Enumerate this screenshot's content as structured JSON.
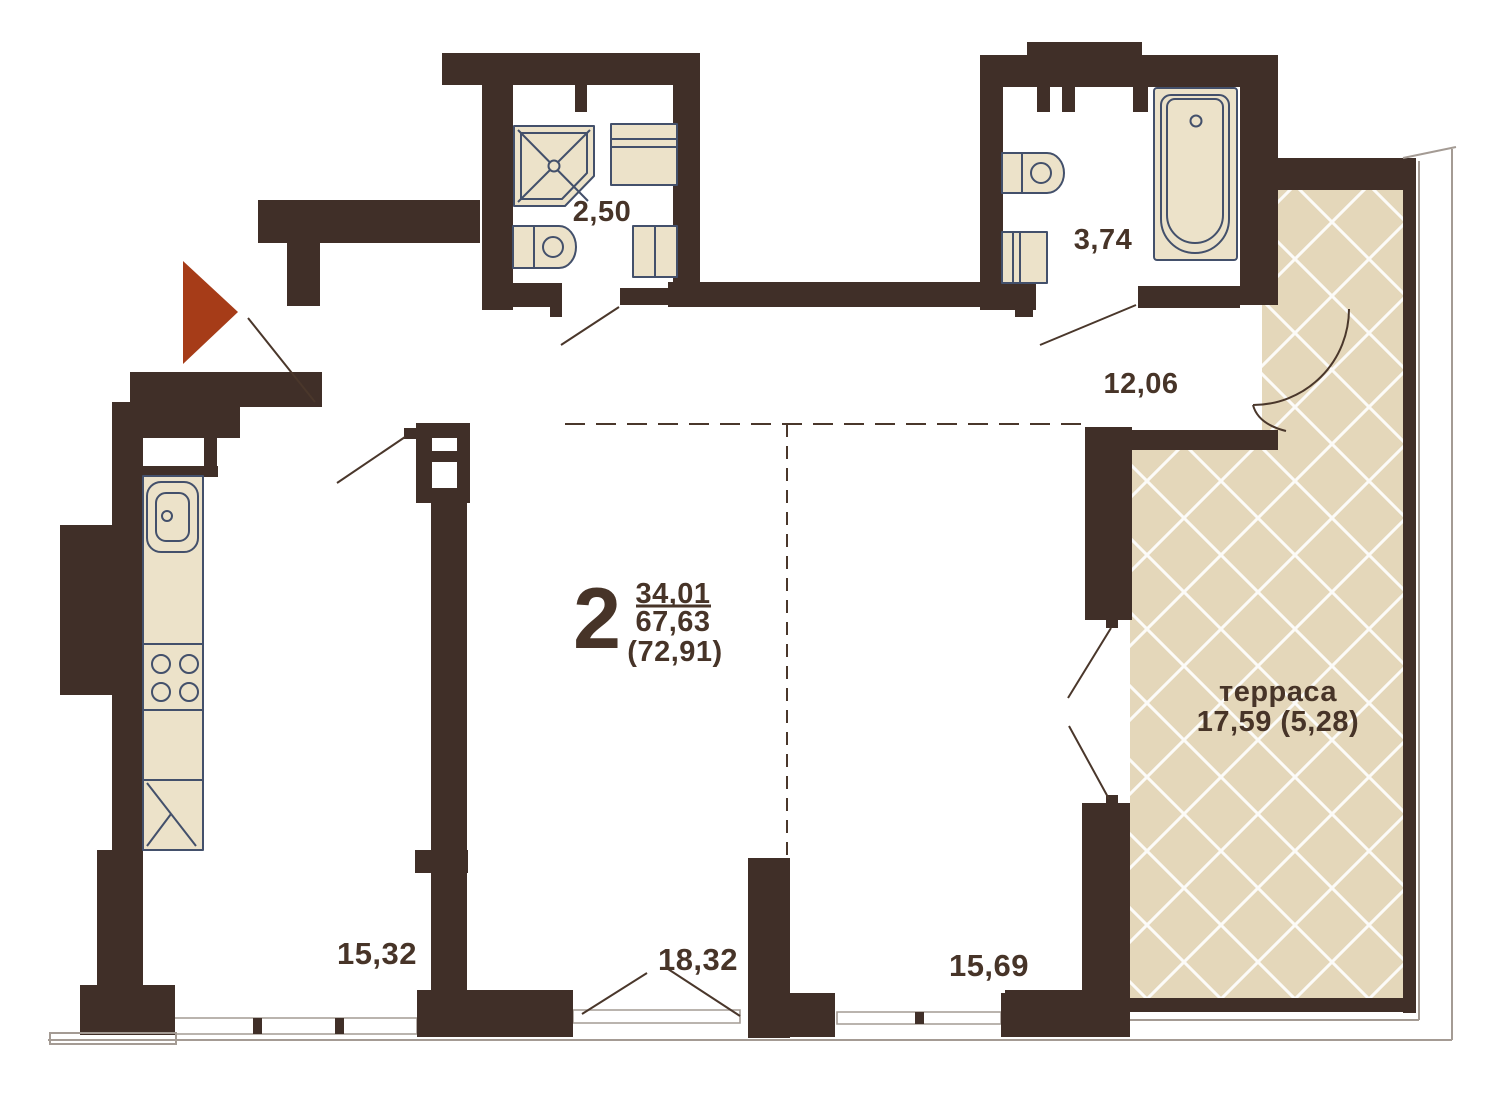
{
  "plan": {
    "unit": {
      "rooms_count": "2",
      "area_living": "34,01",
      "area_apartment": "67,63",
      "area_total": "(72,91)"
    },
    "rooms": {
      "shower_room": "2,50",
      "bathroom": "3,74",
      "hallway": "12,06",
      "kitchen_living": "15,32",
      "living_room": "18,32",
      "bedroom": "15,69",
      "terrace_label": "терраса",
      "terrace_area": "17,59 (5,28)"
    },
    "fixtures": [
      "corner-shower",
      "washing-machine",
      "toilet",
      "cabinet",
      "bathtub",
      "kitchen-sink",
      "stove",
      "fridge"
    ],
    "colors": {
      "wall": "#402f28",
      "text": "#473428",
      "fixture_fill": "#ece2c9",
      "fixture_stroke": "#43506b",
      "terrace_fill": "#e4d7ba",
      "outline": "#a49b94",
      "entrance_marker": "#a63c18"
    }
  }
}
